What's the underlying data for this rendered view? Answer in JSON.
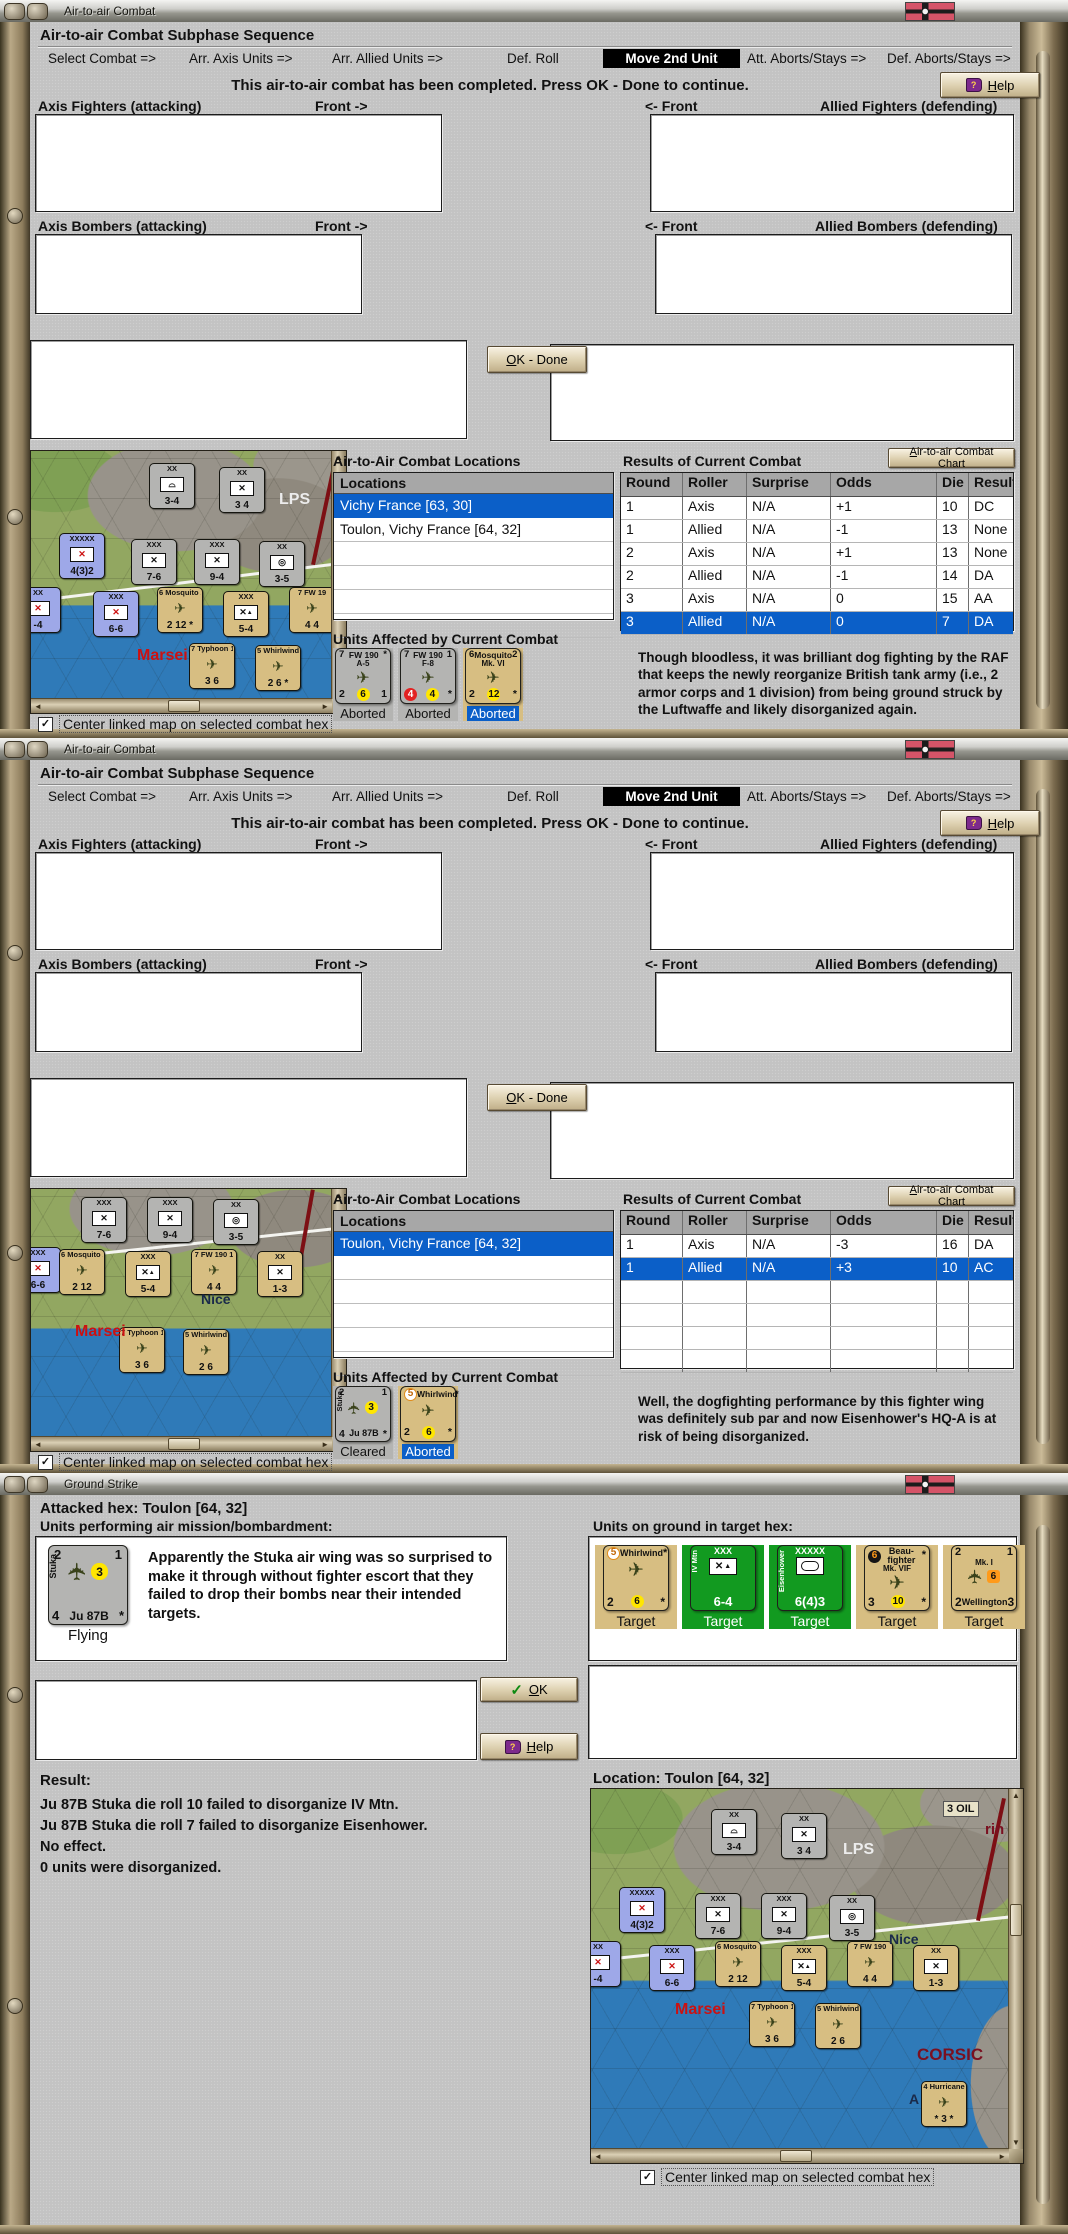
{
  "icons": {
    "check": "✓",
    "up": "▲",
    "down": "▼",
    "left": "◄",
    "right": "►",
    "help_q": "?"
  },
  "checkbox_label": "Center linked map on selected combat hex",
  "tabs": [
    {
      "label": "Select Combat =>",
      "style": {
        "left": "18px"
      }
    },
    {
      "label": "Arr. Axis Units =>",
      "style": {
        "left": "159px"
      }
    },
    {
      "label": "Arr. Allied Units =>",
      "style": {
        "left": "302px"
      }
    },
    {
      "label": "Def. Roll",
      "style": {
        "left": "477px"
      }
    },
    {
      "label": "Move 2nd Unit",
      "cls": "active",
      "style": {
        "left": "573px",
        "width": "137px"
      }
    },
    {
      "label": "Att. Aborts/Stays =>",
      "style": {
        "left": "717px"
      }
    },
    {
      "label": "Def. Aborts/Stays =>",
      "style": {
        "left": "857px"
      }
    }
  ],
  "w1": {
    "title": "Air-to-air Combat",
    "header": "Air-to-air Combat Subphase Sequence",
    "message": "This air-to-air combat has been completed.  Press OK - Done to continue.",
    "help": "Help",
    "ok_done": "OK - Done",
    "labels": {
      "axis_fighters": "Axis Fighters (attacking)",
      "front_r": "Front ->",
      "front_l": "<- Front",
      "allied_fighters": "Allied Fighters (defending)",
      "axis_bombers": "Axis Bombers (attacking)",
      "allied_bombers": "Allied Bombers (defending)"
    },
    "locations_title": "Air-to-Air Combat Locations",
    "locations_header": "Locations",
    "locations": [
      {
        "label": "Vichy France [63, 30]",
        "cls": "sel"
      },
      {
        "label": "Toulon, Vichy France [64, 32]"
      },
      {},
      {},
      {},
      {}
    ],
    "results_title": "Results of Current Combat",
    "chart_button": "Air-to-air Combat Chart",
    "results_headers": {
      "round": "Round",
      "roller": "Roller",
      "surprise": "Surprise",
      "odds": "Odds",
      "die": "Die",
      "result": "Result"
    },
    "results": [
      {
        "round": "1",
        "roller": "Axis",
        "surprise": "N/A",
        "odds": "+1",
        "die": "10",
        "result": "DC"
      },
      {
        "round": "1",
        "roller": "Allied",
        "surprise": "N/A",
        "odds": "-1",
        "die": "13",
        "result": "None"
      },
      {
        "round": "2",
        "roller": "Axis",
        "surprise": "N/A",
        "odds": "+1",
        "die": "13",
        "result": "None"
      },
      {
        "round": "2",
        "roller": "Allied",
        "surprise": "N/A",
        "odds": "-1",
        "die": "14",
        "result": "DA"
      },
      {
        "round": "3",
        "roller": "Axis",
        "surprise": "N/A",
        "odds": "0",
        "die": "15",
        "result": "AA"
      },
      {
        "round": "3",
        "roller": "Allied",
        "surprise": "N/A",
        "odds": "0",
        "die": "7",
        "result": "DA",
        "cls": "sel"
      }
    ],
    "units_title": "Units Affected by Current Combat",
    "units": [
      {
        "cls": "ug",
        "tl": "7",
        "name": "FW 190",
        "tr": "*",
        "sub": "A-5",
        "sym": "✈",
        "symCls": "plane",
        "bl": "2",
        "chip": "6",
        "chipCls": "y",
        "br": "1",
        "status": "Aborted"
      },
      {
        "cls": "ug",
        "tl": "7",
        "name": "FW 190",
        "tr": "1",
        "sub": "F-8",
        "sym": "✈",
        "symCls": "plane",
        "bl": "4",
        "blCls": "u-chip r",
        "chip": "4",
        "br": "*",
        "status": "Aborted"
      },
      {
        "cls": "ut",
        "tl": "6",
        "name": "Mosquito",
        "tr": "2",
        "sub": "Mk. VI",
        "sym": "✈",
        "symCls": "plane",
        "bl": "2",
        "chip": "12",
        "br": "*",
        "status": "Aborted",
        "statusCls": "sel"
      }
    ],
    "narrative": "Though bloodless, it was brilliant dog fighting by the RAF that keeps the newly reorganize British tank army (i.e., 2 armor corps and 1 division) from being ground struck by the Luftwaffe and likely disorganized again.",
    "map": {
      "counters": [
        {
          "cls": "mg",
          "t": "XX",
          "sym": "⌓",
          "b": "3-4",
          "style": {
            "left": "118px",
            "top": "12px"
          }
        },
        {
          "cls": "mg",
          "t": "XX",
          "sym": "✕",
          "b": "3 4",
          "style": {
            "left": "188px",
            "top": "16px"
          }
        },
        {
          "cls": "mb",
          "t": "XXXXX",
          "sym": "✕",
          "symCls": "r",
          "b": "4(3)2",
          "style": {
            "left": "28px",
            "top": "82px"
          }
        },
        {
          "cls": "mg",
          "t": "XXX",
          "sym": "✕",
          "b": "7-6",
          "style": {
            "left": "100px",
            "top": "88px"
          }
        },
        {
          "cls": "mg",
          "t": "XXX",
          "sym": "✕",
          "b": "9-4",
          "style": {
            "left": "163px",
            "top": "88px"
          }
        },
        {
          "cls": "mg",
          "t": "XX",
          "sym": "◎",
          "b": "3-5",
          "style": {
            "left": "228px",
            "top": "90px"
          }
        },
        {
          "cls": "mb",
          "t": "XX",
          "sym": "✕",
          "symCls": "r",
          "b": "-4",
          "style": {
            "left": "-16px",
            "top": "136px"
          }
        },
        {
          "cls": "mb",
          "t": "XXX",
          "sym": "✕",
          "symCls": "r",
          "b": "6-6",
          "style": {
            "left": "62px",
            "top": "140px"
          }
        },
        {
          "cls": "mt",
          "t": "6 Mosquito 2",
          "sym": "✈",
          "symCls": "pl",
          "b": "2 12 *",
          "style": {
            "left": "126px",
            "top": "136px"
          }
        },
        {
          "cls": "mt",
          "t": "XXX",
          "sym": "✕",
          "symCls": "mtn",
          "b": "5-4",
          "style": {
            "left": "192px",
            "top": "140px"
          }
        },
        {
          "cls": "mt",
          "t": "7 FW 19",
          "sym": "✈",
          "symCls": "pl",
          "b": "4 4",
          "style": {
            "left": "258px",
            "top": "136px"
          }
        },
        {
          "cls": "mt",
          "t": "7 Typhoon 1",
          "sym": "✈",
          "symCls": "pl",
          "b": "3 6",
          "style": {
            "left": "158px",
            "top": "192px"
          }
        },
        {
          "cls": "mt",
          "t": "5 Whirlwind",
          "sym": "✈",
          "symCls": "pl",
          "b": "2 6 *",
          "style": {
            "left": "224px",
            "top": "194px"
          }
        }
      ],
      "labels": [
        {
          "text": "LPS",
          "style": {
            "left": "248px",
            "top": "40px",
            "color": "#ececec",
            "fontSize": "16px"
          }
        },
        {
          "text": "Marsei",
          "style": {
            "left": "106px",
            "top": "196px",
            "color": "#cc1111",
            "fontSize": "16px"
          }
        }
      ]
    }
  },
  "w2": {
    "title": "Air-to-air Combat",
    "header": "Air-to-air Combat Subphase Sequence",
    "message": "This air-to-air combat has been completed.  Press OK - Done to continue.",
    "help": "Help",
    "ok_done": "OK - Done",
    "labels": {
      "axis_fighters": "Axis Fighters (attacking)",
      "front_r": "Front ->",
      "front_l": "<- Front",
      "allied_fighters": "Allied Fighters (defending)",
      "axis_bombers": "Axis Bombers (attacking)",
      "allied_bombers": "Allied Bombers (defending)"
    },
    "locations_title": "Air-to-Air Combat Locations",
    "locations_header": "Locations",
    "locations": [
      {
        "label": "Toulon, Vichy France [64, 32]",
        "cls": "sel"
      },
      {},
      {},
      {},
      {},
      {}
    ],
    "results_title": "Results of Current Combat",
    "chart_button": "Air-to-air Combat Chart",
    "results_headers": {
      "round": "Round",
      "roller": "Roller",
      "surprise": "Surprise",
      "odds": "Odds",
      "die": "Die",
      "result": "Result"
    },
    "results": [
      {
        "round": "1",
        "roller": "Axis",
        "surprise": "N/A",
        "odds": "-3",
        "die": "16",
        "result": "DA"
      },
      {
        "round": "1",
        "roller": "Allied",
        "surprise": "N/A",
        "odds": "+3",
        "die": "10",
        "result": "AC",
        "cls": "sel"
      },
      {},
      {},
      {},
      {}
    ],
    "units_title": "Units Affected by Current Combat",
    "units": [
      {
        "cls": "ug",
        "tl": "2",
        "tr": "1",
        "side": "Stuka",
        "sym": "✈",
        "symCls": "plane vert",
        "midchip": "3",
        "bl": "4",
        "bname": "Ju 87B",
        "br": "*",
        "status": "Cleared"
      },
      {
        "cls": "ut",
        "tl": "5",
        "tlCls": "u-chip w",
        "name": "Whirlwind",
        "tr": "*",
        "sym": "✈",
        "symCls": "plane",
        "bl": "2",
        "chip": "6",
        "br": "*",
        "status": "Aborted",
        "statusCls": "sel"
      }
    ],
    "narrative": "Well, the dogfighting performance by this fighter wing was definitely sub par and now Eisenhower's HQ-A is at risk of being disorganized.",
    "map": {
      "counters": [
        {
          "cls": "mg",
          "t": "XXX",
          "sym": "✕",
          "b": "7-6",
          "style": {
            "left": "50px",
            "top": "8px"
          }
        },
        {
          "cls": "mg",
          "t": "XXX",
          "sym": "✕",
          "b": "9-4",
          "style": {
            "left": "116px",
            "top": "8px"
          }
        },
        {
          "cls": "mg",
          "t": "XX",
          "sym": "◎",
          "b": "3-5",
          "style": {
            "left": "182px",
            "top": "10px"
          }
        },
        {
          "cls": "mb",
          "t": "XXX",
          "sym": "✕",
          "symCls": "r",
          "b": "6-6",
          "style": {
            "left": "-16px",
            "top": "58px"
          }
        },
        {
          "cls": "mt",
          "t": "6 Mosquito 2",
          "sym": "✈",
          "symCls": "pl",
          "b": "2 12",
          "style": {
            "left": "28px",
            "top": "60px"
          }
        },
        {
          "cls": "mt",
          "t": "XXX",
          "sym": "✕",
          "symCls": "mtn",
          "b": "5-4",
          "style": {
            "left": "94px",
            "top": "62px"
          }
        },
        {
          "cls": "mt",
          "t": "7 FW 190 1",
          "sym": "✈",
          "symCls": "pl",
          "b": "4 4",
          "style": {
            "left": "160px",
            "top": "60px"
          }
        },
        {
          "cls": "mt",
          "t": "XX",
          "sym": "✕",
          "b": "1-3",
          "style": {
            "left": "226px",
            "top": "62px"
          }
        },
        {
          "cls": "mt",
          "t": "7 Typhoon 1",
          "sym": "✈",
          "symCls": "pl",
          "b": "3 6",
          "style": {
            "left": "88px",
            "top": "138px"
          }
        },
        {
          "cls": "mt",
          "t": "5 Whirlwind",
          "sym": "✈",
          "symCls": "pl",
          "b": "2 6",
          "style": {
            "left": "152px",
            "top": "140px"
          }
        }
      ],
      "labels": [
        {
          "text": "Nice",
          "style": {
            "left": "170px",
            "top": "102px",
            "color": "#1a2a4a",
            "fontSize": "14px"
          }
        },
        {
          "text": "Marsei",
          "style": {
            "left": "44px",
            "top": "134px",
            "color": "#cc1111",
            "fontSize": "16px"
          }
        }
      ]
    }
  },
  "w3": {
    "title": "Ground Strike",
    "attacked_hex": "Attacked hex: Toulon  [64, 32]",
    "performing_label": "Units performing air mission/bombardment:",
    "ground_label": "Units on ground in target hex:",
    "flying": {
      "tl": "2",
      "tr": "1",
      "side": "Stuka",
      "sym": "✈",
      "midchip": "3",
      "bl": "4",
      "bname": "Ju 87B",
      "br": "*",
      "status": "Flying"
    },
    "narrative": "Apparently the Stuka air wing was so surprised to make it through without fighter escort that they failed to drop their bombs near their intended targets.",
    "ok": "OK",
    "help": "Help",
    "targets": [
      {
        "cls": "ut",
        "tl": "5",
        "tlCls": "u-chip w",
        "name": "Whirlwind",
        "tr": "*",
        "sym": "✈",
        "symCls": "plane",
        "bl": "2",
        "chip": "6",
        "br": "*",
        "status": "Target"
      },
      {
        "cls": "un",
        "side": "IV Mtn",
        "name": "XXX",
        "sym": "✕",
        "symCls": "gs mtn",
        "bname": "6-4",
        "bnameCls": "big",
        "status": "Target"
      },
      {
        "cls": "un",
        "side": "Eisenhower",
        "name": "XXXXX",
        "symCls": "hq",
        "bname": "6(4)3",
        "bnameCls": "big",
        "status": "Target"
      },
      {
        "cls": "ut",
        "tl": "6",
        "tlCls": "u-chip k",
        "name": "Beau-fighter",
        "tr": "*",
        "sub": "Mk. VIF",
        "sym": "✈",
        "symCls": "plane",
        "bl": "3",
        "chip": "10",
        "br": "*",
        "status": "Target"
      },
      {
        "cls": "ut",
        "tl": "2",
        "tr": "1",
        "sub": "Mk. I",
        "sym": "✈",
        "symCls": "plane vert",
        "midchip": "6",
        "midchipCls": "o",
        "bl": "2",
        "bname": "Wellington",
        "br": "3",
        "status": "Target"
      }
    ],
    "result_title": "Result:",
    "result_lines": [
      {
        "text": "Ju 87B Stuka die roll 10 failed to disorganize IV Mtn."
      },
      {
        "text": "Ju 87B Stuka die roll 7 failed to disorganize Eisenhower."
      },
      {
        "text": "No effect."
      },
      {
        "text": "0 units were disorganized."
      }
    ],
    "location_label": "Location:  Toulon  [64, 32]",
    "map": {
      "counters": [
        {
          "cls": "mg",
          "t": "XX",
          "sym": "⌓",
          "b": "3-4",
          "style": {
            "left": "120px",
            "top": "20px"
          }
        },
        {
          "cls": "mg",
          "t": "XX",
          "sym": "✕",
          "b": "3 4",
          "style": {
            "left": "190px",
            "top": "24px"
          }
        },
        {
          "cls": "mb",
          "t": "XXXXX",
          "sym": "✕",
          "symCls": "r",
          "b": "4(3)2",
          "style": {
            "left": "28px",
            "top": "98px"
          }
        },
        {
          "cls": "mg",
          "t": "XXX",
          "sym": "✕",
          "b": "7-6",
          "style": {
            "left": "104px",
            "top": "104px"
          }
        },
        {
          "cls": "mg",
          "t": "XXX",
          "sym": "✕",
          "b": "9-4",
          "style": {
            "left": "170px",
            "top": "104px"
          }
        },
        {
          "cls": "mg",
          "t": "XX",
          "sym": "◎",
          "b": "3-5",
          "style": {
            "left": "238px",
            "top": "106px"
          }
        },
        {
          "cls": "mb",
          "t": "XX",
          "sym": "✕",
          "symCls": "r",
          "b": "-4",
          "style": {
            "left": "-16px",
            "top": "152px"
          }
        },
        {
          "cls": "mb",
          "t": "XXX",
          "sym": "✕",
          "symCls": "r",
          "b": "6-6",
          "style": {
            "left": "58px",
            "top": "156px"
          }
        },
        {
          "cls": "mt",
          "t": "6 Mosquito 2",
          "sym": "✈",
          "symCls": "pl",
          "b": "2 12",
          "style": {
            "left": "124px",
            "top": "152px"
          }
        },
        {
          "cls": "mt",
          "t": "XXX",
          "sym": "✕",
          "symCls": "mtn",
          "b": "5-4",
          "style": {
            "left": "190px",
            "top": "156px"
          }
        },
        {
          "cls": "mt",
          "t": "7 FW 190",
          "sym": "✈",
          "symCls": "pl",
          "b": "4 4",
          "style": {
            "left": "256px",
            "top": "152px"
          }
        },
        {
          "cls": "mt",
          "t": "XX",
          "sym": "✕",
          "b": "1-3",
          "style": {
            "left": "322px",
            "top": "156px"
          }
        },
        {
          "cls": "mt",
          "t": "7 Typhoon 1",
          "sym": "✈",
          "symCls": "pl",
          "b": "3 6",
          "style": {
            "left": "158px",
            "top": "212px"
          }
        },
        {
          "cls": "mt",
          "t": "5 Whirlwind",
          "sym": "✈",
          "symCls": "pl",
          "b": "2 6",
          "style": {
            "left": "224px",
            "top": "214px"
          }
        },
        {
          "cls": "mt",
          "t": "4 Hurricane",
          "sym": "✈",
          "symCls": "pl",
          "b": "* 3 *",
          "style": {
            "left": "330px",
            "top": "292px"
          }
        }
      ],
      "labels": [
        {
          "text": "LPS",
          "style": {
            "left": "252px",
            "top": "52px",
            "color": "#ececec",
            "fontSize": "16px"
          }
        },
        {
          "text": "3 OIL",
          "style": {
            "left": "352px",
            "top": "12px",
            "color": "#111111",
            "fontSize": "11px",
            "background": "#e8e2c8",
            "padding": "1px 3px",
            "border": "1px solid #555555"
          }
        },
        {
          "text": "rin",
          "style": {
            "left": "394px",
            "top": "32px",
            "color": "#7a1020",
            "fontSize": "15px"
          }
        },
        {
          "text": "Nice",
          "style": {
            "left": "298px",
            "top": "142px",
            "color": "#1a2a4a",
            "fontSize": "14px"
          }
        },
        {
          "text": "Marsei",
          "style": {
            "left": "84px",
            "top": "212px",
            "color": "#cc1111",
            "fontSize": "16px"
          }
        },
        {
          "text": "CORSIC",
          "style": {
            "left": "326px",
            "top": "256px",
            "color": "#7a1020",
            "fontSize": "17px"
          }
        },
        {
          "text": "A",
          "style": {
            "left": "318px",
            "top": "302px",
            "color": "#1a2a4a",
            "fontSize": "14px"
          }
        }
      ]
    }
  }
}
